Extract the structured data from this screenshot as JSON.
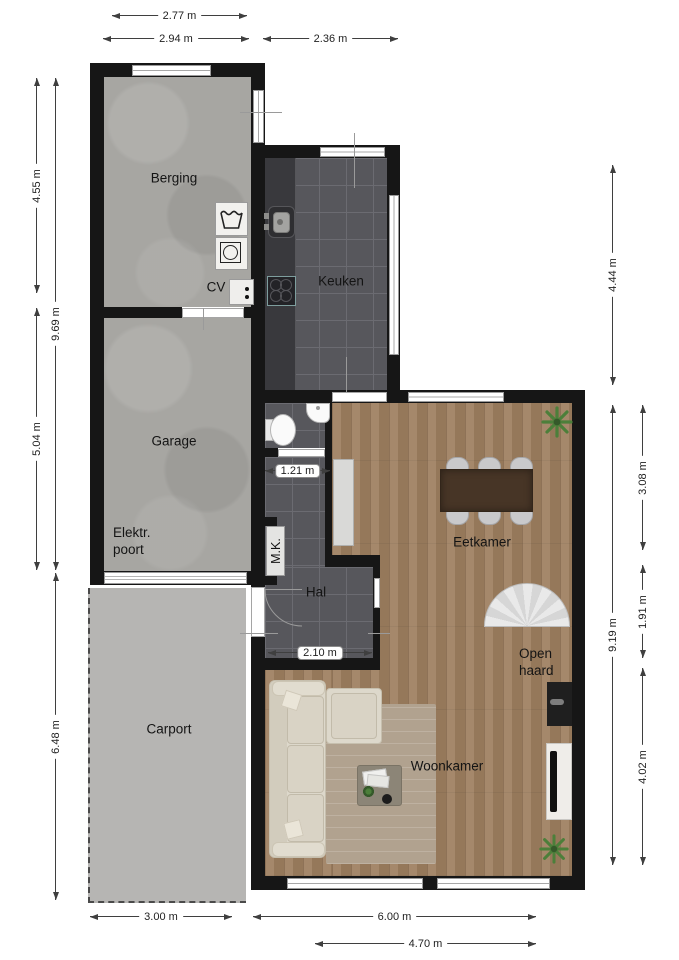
{
  "title": "Floor plan ground floor",
  "rooms": {
    "berging": "Berging",
    "keuken": "Keuken",
    "garage": "Garage",
    "elektr_line1": "Elektr.",
    "elektr_line2": "poort",
    "carport": "Carport",
    "hal": "Hal",
    "mk": "M.K.",
    "cv": "CV",
    "eetkamer": "Eetkamer",
    "openhaard_line1": "Open",
    "openhaard_line2": "haard",
    "woonkamer": "Woonkamer"
  },
  "dimensions": {
    "top": [
      "2.77 m",
      "2.94 m",
      "2.36 m"
    ],
    "left": [
      "4.55 m",
      "9.69 m",
      "5.04 m",
      "6.48 m"
    ],
    "right": [
      "4.44 m",
      "9.19 m",
      "3.08 m",
      "1.91 m",
      "4.02 m"
    ],
    "bottom": [
      "3.00 m",
      "6.00 m",
      "4.70 m"
    ],
    "inner": [
      "1.21 m",
      "2.10 m"
    ]
  },
  "icons": {
    "wash_symbol": "laundry-wash-tub-icon",
    "washer": "washing-machine-icon",
    "plant": "plant-icon",
    "stairs": "spiral-stairs-icon"
  },
  "colors": {
    "wall": "#161616",
    "tile": "#57575c",
    "tileline": "#6b6b71",
    "wood": "#9e7f60",
    "concrete": "#a7a6a2",
    "carport": "#b6b5b3",
    "dim": "#3f3f3f"
  }
}
